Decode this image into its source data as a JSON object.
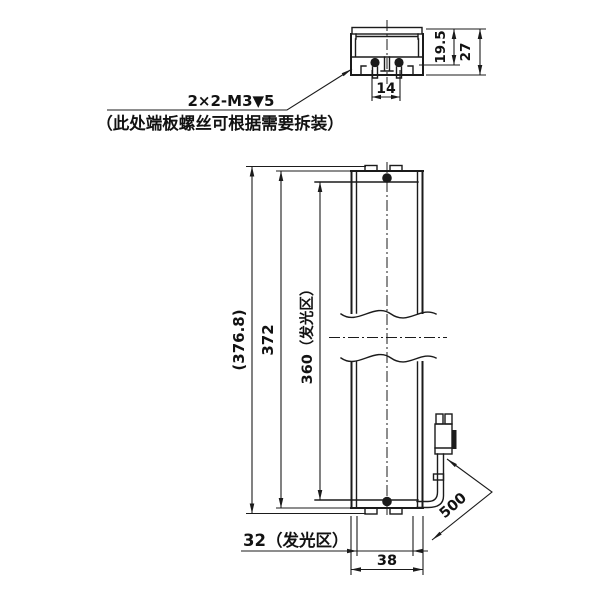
{
  "page": {
    "background": "#ffffff",
    "line_color": "#1b1b1b"
  },
  "callout": {
    "thread_spec": "2×2-M3▼5",
    "note": "（此处端板螺丝可根据需要拆装）"
  },
  "section_view": {
    "dim_screw_spacing": "14",
    "dim_depth_inner": "19.5",
    "dim_depth_overall": "27"
  },
  "front_view": {
    "dim_overall_length": "(376.8)",
    "dim_body_length": "372",
    "dim_glow_length": "360（发光区）",
    "dim_glow_width": "32（发光区）",
    "dim_body_width": "38",
    "dim_cable_length": "500"
  }
}
